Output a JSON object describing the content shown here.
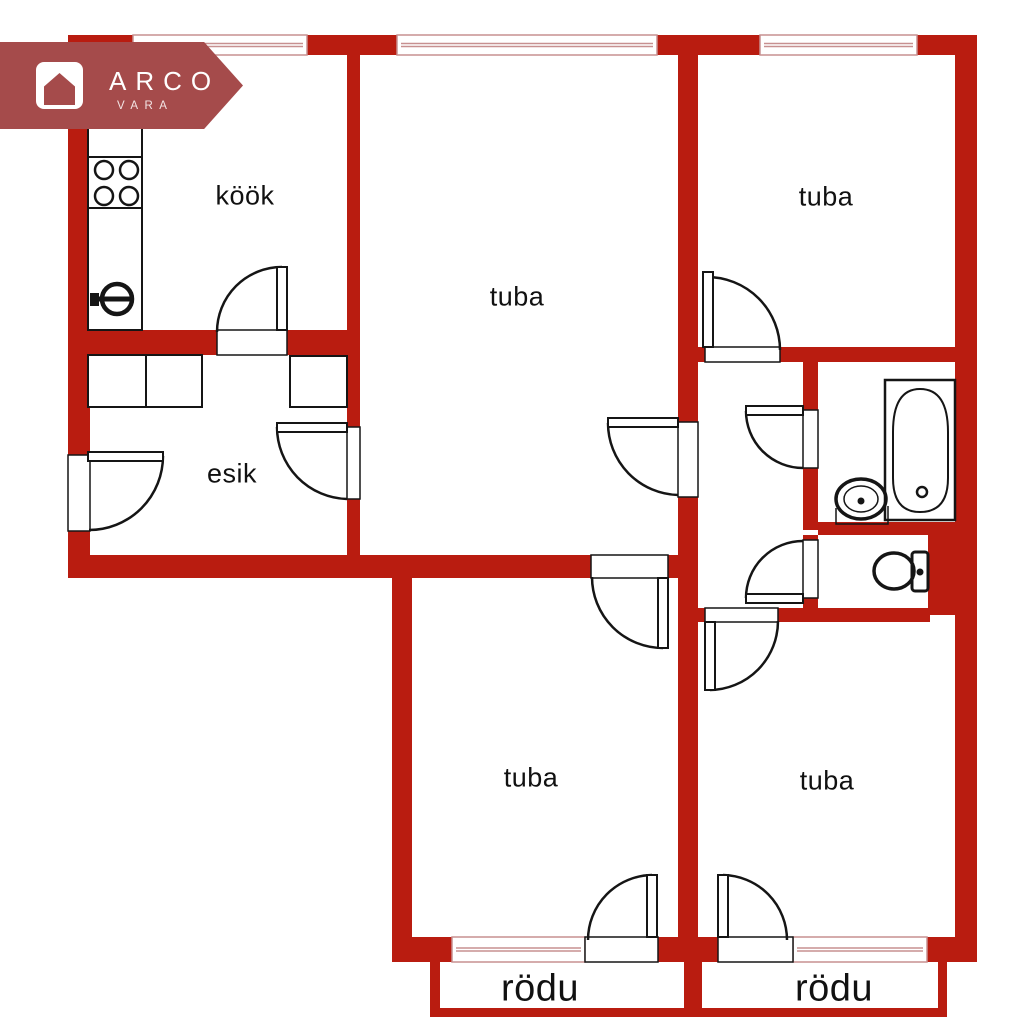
{
  "logo": {
    "brand": "ARCO",
    "sub": "VARA"
  },
  "rooms": [
    {
      "id": "kook",
      "label": "köök",
      "x": 245,
      "y": 196,
      "size": 27
    },
    {
      "id": "tuba-center",
      "label": "tuba",
      "x": 517,
      "y": 297,
      "size": 27
    },
    {
      "id": "tuba-top-right",
      "label": "tuba",
      "x": 826,
      "y": 197,
      "size": 27
    },
    {
      "id": "esik",
      "label": "esik",
      "x": 232,
      "y": 474,
      "size": 27
    },
    {
      "id": "tuba-bottom-left",
      "label": "tuba",
      "x": 531,
      "y": 778,
      "size": 27
    },
    {
      "id": "tuba-bottom-right",
      "label": "tuba",
      "x": 827,
      "y": 781,
      "size": 27
    },
    {
      "id": "rodu-left",
      "label": "rödu",
      "x": 540,
      "y": 989,
      "size": 38
    },
    {
      "id": "rodu-right",
      "label": "rödu",
      "x": 834,
      "y": 989,
      "size": 38
    }
  ],
  "colors": {
    "wall": "#b91c10",
    "logo_banner": "#a54b4b",
    "window_line": "#c79090",
    "outline": "#151515",
    "text": "#111111",
    "background": "#ffffff"
  }
}
